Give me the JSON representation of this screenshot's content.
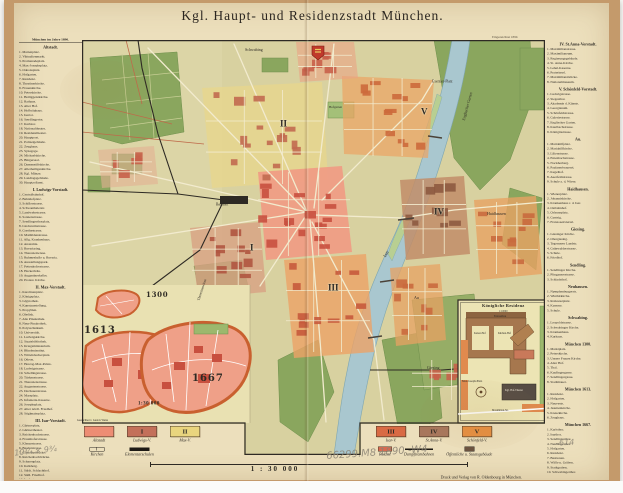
{
  "title": "Kgl. Haupt- und Residenzstadt München.",
  "plate_note": "Eingezeichnet 1890.",
  "scale": {
    "text": "1 : 30 000"
  },
  "imprint": "Druck und Verlag von R. Oldenbourg in München.",
  "left_index": {
    "header": "München im Jahre 1890.",
    "sections": [
      {
        "title": "Altstadt.",
        "entries": [
          "1. Marienplatz.",
          "2. Viktualienmarkt.",
          "3. Promenadeplatz.",
          "4. Max-Josephsplatz.",
          "5. Odeonsplatz.",
          "6. Hofgarten.",
          "7. Residenz.",
          "8. Theatinerkirche.",
          "9. Frauenkirche.",
          "10. Peterskirche.",
          "11. Heiliggeistkirche.",
          "12. Rathaus.",
          "13. Alter Hof.",
          "14. Hofbräuhaus.",
          "15. Isartor.",
          "16. Sendlingertor.",
          "17. Karlstor.",
          "18. Nationaltheater.",
          "19. Residenztheater.",
          "20. Hauptpost.",
          "21. Polizeigebäude.",
          "22. Zeughaus.",
          "23. Synagoge.",
          "24. Michaelskirche.",
          "25. Bürgersaal.",
          "26. Damenstiftskirche.",
          "27. Allerheiligenkirche.",
          "28. Kgl. Münze.",
          "29. Landtagsgebäude.",
          "30. Hauptzollamt."
        ]
      },
      {
        "title": "I. Ludwigs-Vorstadt.",
        "entries": [
          "1. Centralbahnhof.",
          "2. Bahnhofplatz.",
          "3. Schillerstrasse.",
          "4. Schwanthalerstr.",
          "5. Landwehrstrasse.",
          "6. Sonnenstrasse.",
          "7. Sendlingerthorplatz.",
          "8. Lindwurmstrasse.",
          "9. Goethestrasse.",
          "10. Mathildenstrasse.",
          "11. Allg. Krankenhaus.",
          "12. Anatomie.",
          "13. Bavariaring.",
          "14. Theresienwiese.",
          "15. Ruhmeshalle u. Bavaria.",
          "16. Ausstellungspark.",
          "17. Pettenkoferstrasse.",
          "18. Hackerbräu.",
          "19. Augustinerkeller.",
          "20. Protest. Kirche."
        ]
      },
      {
        "title": "II. Max-Vorstadt.",
        "entries": [
          "1. Karolinenplatz.",
          "2. Königsplatz.",
          "3. Glyptothek.",
          "4. Kunstausstellung.",
          "5. Propyläen.",
          "6. Obelisk.",
          "7. Alte Pinakothek.",
          "8. Neue Pinakothek.",
          "9. Polytechnikum.",
          "10. Universität.",
          "11. Ludwigskirche.",
          "12. Staatsbibliothek.",
          "13. Kriegsministerium.",
          "14. Blindeninstitut.",
          "15. Wittelsbacherplatz.",
          "16. Odeon.",
          "17. Herzog-Max-Palais.",
          "18. Ludwigstrasse.",
          "19. Schellingstrasse.",
          "20. Türkenstrasse.",
          "21. Theresienstrasse.",
          "22. Augustenstrasse.",
          "23. Dachauerstrasse.",
          "24. Marsplatz.",
          "25. Infanterie-Kaserne.",
          "26. Josephsplatz.",
          "27. Alter nördl. Friedhof.",
          "28. Stiglmaierplatz."
        ]
      },
      {
        "title": "III. Isar-Vorstadt.",
        "entries": [
          "1. Gärtnerplatz.",
          "2. Gärtnertheater.",
          "3. Reichenbachstrasse.",
          "4. Fraunhoferstrasse.",
          "5. Klenzestrasse.",
          "6. Baaderstrasse.",
          "7. Corneliusbrücke.",
          "8. Reichenbachbrücke.",
          "9. Schyrenplatz.",
          "10. Kalkberg.",
          "11. Städt. Schlachthof.",
          "12. Südl. Friedhof.",
          "13. Isarlust."
        ]
      }
    ]
  },
  "right_index": {
    "sections": [
      {
        "title": "IV. St.Anna-Vorstadt.",
        "entries": [
          "1. Maximilianstrasse.",
          "2. Maximilianeum.",
          "3. Regierungsgebäude.",
          "4. St. Anna-Kirche.",
          "5. Lehel-Kaserne.",
          "6. Praterinsel.",
          "7. Maximiliansbrücke.",
          "8. Nationalmuseum."
        ]
      },
      {
        "title": "V. Schönfeld-Vorstadt.",
        "entries": [
          "1. Ludwigstrasse.",
          "2. Siegesthor.",
          "3. Akademie d. Künste.",
          "4. Georgianum.",
          "5. Schönfeldstrasse.",
          "6. Galeriestrasse.",
          "7. Englischer Garten.",
          "8. Kaulbachstrasse.",
          "9. Königinstrasse."
        ]
      },
      {
        "title": "Au.",
        "entries": [
          "1. Mariahilfplatz.",
          "2. Mariahilfkirche.",
          "3. Lilienstrasse.",
          "4. Entenbachstrasse.",
          "5. Nockherberg.",
          "6. Paulanerbrauerei.",
          "7. Kegelhof.",
          "8. Auerfeldstrasse.",
          "9. Schule a. d. Wiese."
        ]
      },
      {
        "title": "Haidhausen.",
        "entries": [
          "1. Wienerplatz.",
          "2. Johanniskirche.",
          "3. Krankenhaus r. d. Isar.",
          "4. Ostbahnhof.",
          "5. Orleansplatz.",
          "6. Gasteig.",
          "7. Franzosenviertel."
        ]
      },
      {
        "title": "Giesing.",
        "entries": [
          "1. Giesinger Kirche.",
          "2. Obergiesing.",
          "3. Tegernseer Landstr.",
          "4. Grünwalderstrasse.",
          "5. Schule.",
          "6. Friedhof."
        ]
      },
      {
        "title": "Sendling.",
        "entries": [
          "1. Sendlinger Kirche.",
          "2. Plinganserstrasse.",
          "3. Schlachthof."
        ]
      },
      {
        "title": "Neuhausen.",
        "entries": [
          "1. Nymphenburgerstr.",
          "2. Winthirkirche.",
          "3. Rotkreuzplatz.",
          "4. Kaserne.",
          "5. Schule."
        ]
      },
      {
        "title": "Schwabing.",
        "entries": [
          "1. Leopoldstrasse.",
          "2. Schwabinger Kirche.",
          "3. Krankenhaus.",
          "4. Kurhaus."
        ]
      },
      {
        "title": "München 1300.",
        "entries": [
          "1. Marktplatz.",
          "2. Peterskirche.",
          "3. Unsere Frauen Kirche.",
          "4. Alter Hof.",
          "5. Thal.",
          "6. Kaufingergasse.",
          "7. Sendlingergasse.",
          "8. Stadtmauer."
        ]
      },
      {
        "title": "München 1613.",
        "entries": [
          "1. Residenz.",
          "2. Hofgarten.",
          "3. Neuveste.",
          "4. Jesuitenkirche.",
          "5. Kreuzkirche.",
          "6. Zeughaus."
        ]
      },
      {
        "title": "München 1667.",
        "entries": [
          "1. Karlsthor.",
          "2. Isarthor.",
          "3. Sendlingerthor.",
          "4. Neuhauserthor.",
          "5. Hofgarten.",
          "6. Residenz.",
          "7. Bastionen.",
          "8. Wälle u. Gräben.",
          "9. Stadtgraben.",
          "10. Schwabingerthor."
        ]
      }
    ]
  },
  "legend": {
    "left_districts": [
      {
        "numeral": "",
        "label": "Altstadt",
        "color": "#ed8d74"
      },
      {
        "numeral": "I",
        "label": "Ludwigs-V.",
        "color": "#c3705a"
      },
      {
        "numeral": "II",
        "label": "Max-V.",
        "color": "#e9d57e"
      }
    ],
    "left_symbols": [
      {
        "type": "church",
        "label": "Kirchen"
      },
      {
        "type": "blackbar",
        "label": "Elementarschulen"
      }
    ],
    "right_districts": [
      {
        "numeral": "III",
        "label": "Isar-V.",
        "color": "#d96a44"
      },
      {
        "numeral": "IV",
        "label": "St.Anna-V.",
        "color": "#a8775d"
      },
      {
        "numeral": "V",
        "label": "Schönfeld-V.",
        "color": "#e79043"
      }
    ],
    "right_symbols": [
      {
        "type": "redbox",
        "label": "Paläste"
      },
      {
        "type": "tramline",
        "label": "Dampftrambahnen"
      },
      {
        "type": "pubbox",
        "label": "Öffentliche u. Staatsgebäude"
      }
    ]
  },
  "insets": {
    "growth": {
      "years": [
        "1300",
        "1613",
        "1667"
      ],
      "scale": "1:30 000",
      "credit": "Gezeichnet v. Gustav Weiss"
    },
    "residenz": {
      "title": "Königliche Residenz",
      "scale": "1:10000",
      "labels": [
        "Festsaalbau",
        "Kaiser-Hof",
        "Küchen-Hof",
        "Max-Joseph-Platz",
        "Kgl. Hof-Theater",
        "Maximilian-Str."
      ]
    }
  },
  "annotations": {
    "pencil_left": "10¾ × 9¾",
    "pencil_center": "66299.M8 1890 -W4",
    "pencil_right": "-614"
  },
  "overlay": [
    {
      "t": "Schwabing",
      "x": 245,
      "y": 48,
      "fs": 4
    },
    {
      "t": "Englischer Garten",
      "x": 462,
      "y": 120,
      "fs": 4,
      "r": -75
    },
    {
      "t": "Exerzier-Platz",
      "x": 432,
      "y": 80,
      "fs": 3.6
    },
    {
      "t": "Bahnhof",
      "x": 216,
      "y": 203,
      "fs": 3.6
    },
    {
      "t": "Theresienwiese",
      "x": 197,
      "y": 300,
      "fs": 3.6,
      "r": -72
    },
    {
      "t": "Isar",
      "x": 383,
      "y": 256,
      "fs": 4.5,
      "r": -62
    },
    {
      "t": "Haidhausen",
      "x": 487,
      "y": 212,
      "fs": 4
    },
    {
      "t": "Au",
      "x": 414,
      "y": 296,
      "fs": 4
    },
    {
      "t": "Giesing",
      "x": 427,
      "y": 366,
      "fs": 4
    },
    {
      "t": "Hofgarten",
      "x": 329,
      "y": 106,
      "fs": 3.2
    },
    {
      "t": "II",
      "x": 280,
      "y": 120,
      "fs": 9,
      "c": "num"
    },
    {
      "t": "V",
      "x": 421,
      "y": 108,
      "fs": 9,
      "c": "num"
    },
    {
      "t": "IV",
      "x": 434,
      "y": 208,
      "fs": 9,
      "c": "num"
    },
    {
      "t": "III",
      "x": 328,
      "y": 284,
      "fs": 9,
      "c": "num"
    },
    {
      "t": "I",
      "x": 250,
      "y": 244,
      "fs": 9,
      "c": "num"
    },
    {
      "t": "1300",
      "x": 146,
      "y": 292,
      "fs": 7,
      "c": "year"
    },
    {
      "t": "1613",
      "x": 84,
      "y": 326,
      "fs": 10,
      "c": "year"
    },
    {
      "t": "1667",
      "x": 192,
      "y": 374,
      "fs": 10,
      "c": "year"
    },
    {
      "t": "1:30 000",
      "x": 138,
      "y": 401,
      "fs": 5,
      "c": "bold"
    },
    {
      "t": "Gezeichnet v. Gustav Weiss",
      "x": 77,
      "y": 419,
      "fs": 2.8
    },
    {
      "t": "Königliche Residenz",
      "x": 482,
      "y": 304,
      "fs": 4.4,
      "c": "restitle"
    },
    {
      "t": "1:10000",
      "x": 499,
      "y": 310,
      "fs": 2.6
    },
    {
      "t": "Festsaalbau",
      "x": 494,
      "y": 315,
      "fs": 2.6
    },
    {
      "t": "Kaiser-Hof",
      "x": 474,
      "y": 332,
      "fs": 2.6
    },
    {
      "t": "Küchen-Hof",
      "x": 498,
      "y": 332,
      "fs": 2.6
    },
    {
      "t": "Max-Joseph-Platz",
      "x": 462,
      "y": 380,
      "fs": 2.8
    },
    {
      "t": "Kgl. Hof-Theater",
      "x": 505,
      "y": 389,
      "fs": 2.6,
      "c": "microlight"
    },
    {
      "t": "Maximilian-Str.",
      "x": 492,
      "y": 409,
      "fs": 2.6
    },
    {
      "t": "10¾ × 9¾",
      "x": 14,
      "y": 450,
      "fs": 8,
      "c": "pencil",
      "r": -6
    },
    {
      "t": "66299.M8 1890 -W4",
      "x": 326,
      "y": 452,
      "fs": 10,
      "c": "pencil",
      "r": -4
    },
    {
      "t": "-614",
      "x": 556,
      "y": 440,
      "fs": 8,
      "c": "pencil",
      "r": -3
    }
  ]
}
